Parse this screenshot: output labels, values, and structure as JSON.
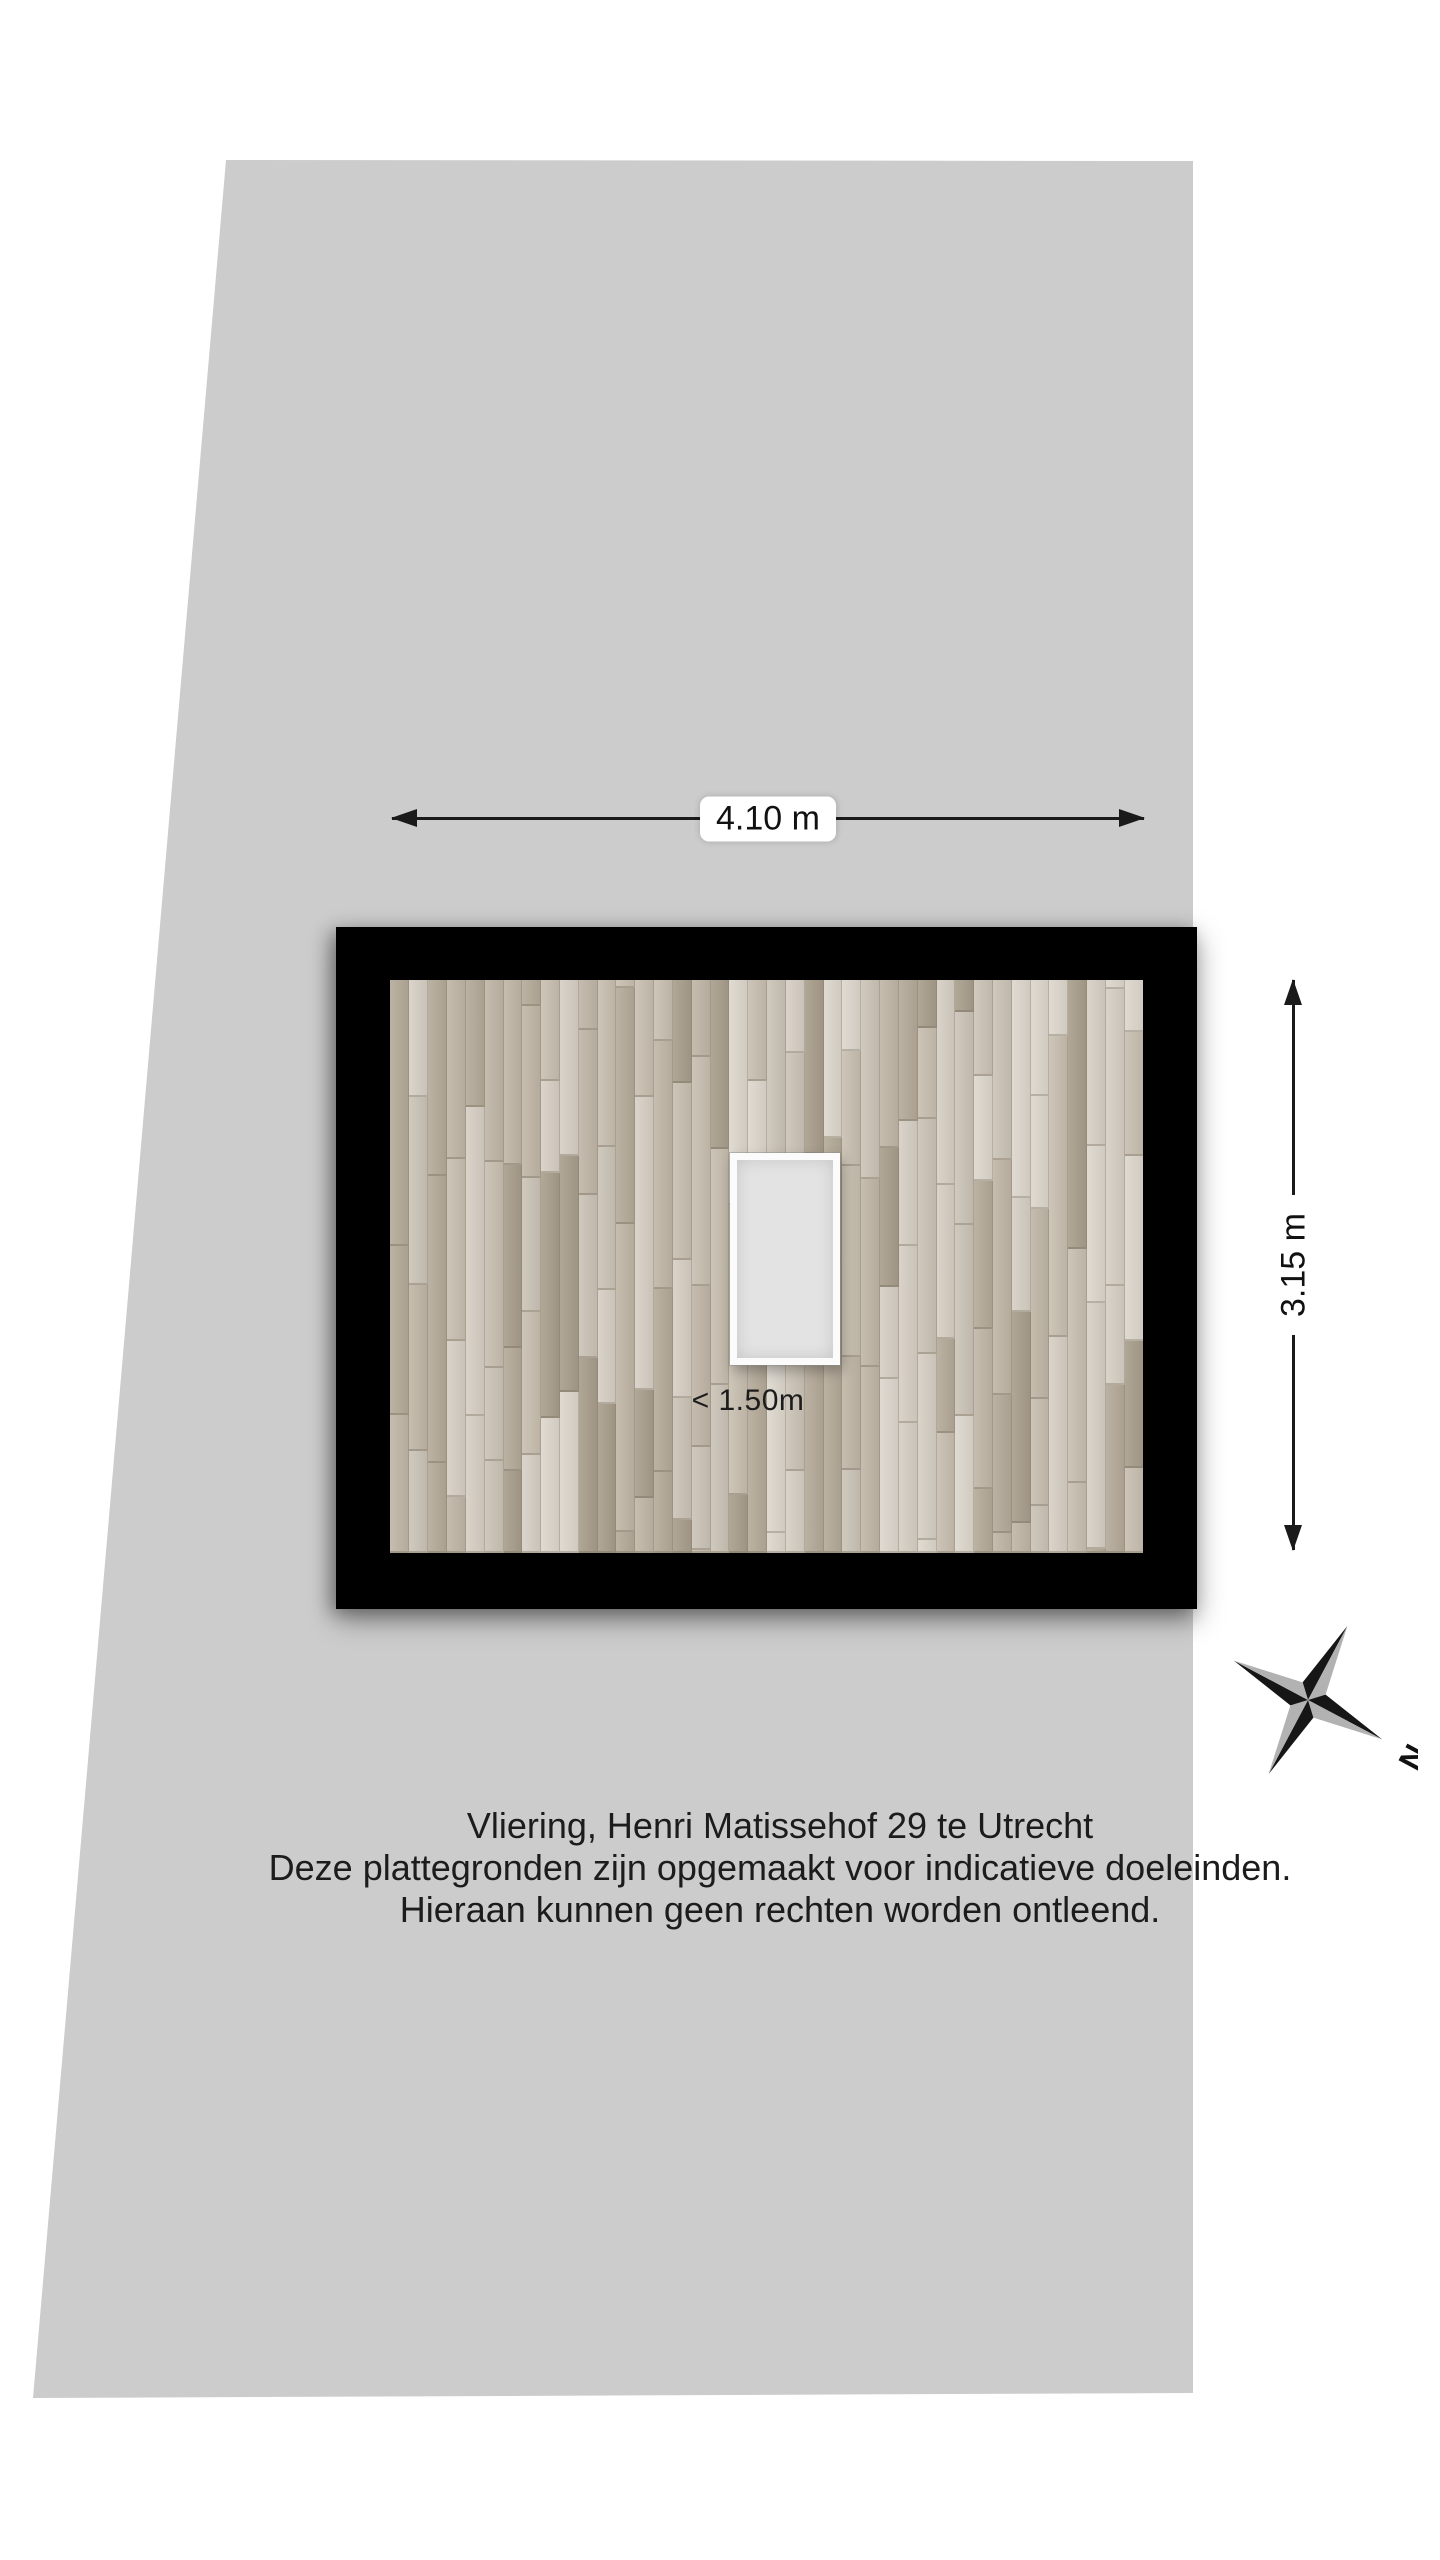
{
  "lot": {
    "fill": "#cccccc"
  },
  "room": {
    "wall_color": "#000000",
    "floor": {
      "palette": [
        "#d6cfc4",
        "#cbc3b6",
        "#c0b6a7",
        "#b5aa99",
        "#a99e8c",
        "#ddd7cd",
        "#c8bfb0"
      ]
    },
    "hatch": {
      "label": "< 1.50m",
      "border_color": "#fbfbfb",
      "fill": "#e3e3e3"
    }
  },
  "dimensions": {
    "width_label": "4.10 m",
    "height_label": "3.15 m"
  },
  "compass": {
    "north_label": "N",
    "black": "#161616",
    "gray": "#b2b2b2"
  },
  "footer": {
    "lines": [
      "Vliering, Henri Matissehof 29 te Utrecht",
      "Deze plattegronden zijn opgemaakt voor indicatieve doeleinden.",
      "Hieraan kunnen geen rechten worden ontleend."
    ]
  }
}
